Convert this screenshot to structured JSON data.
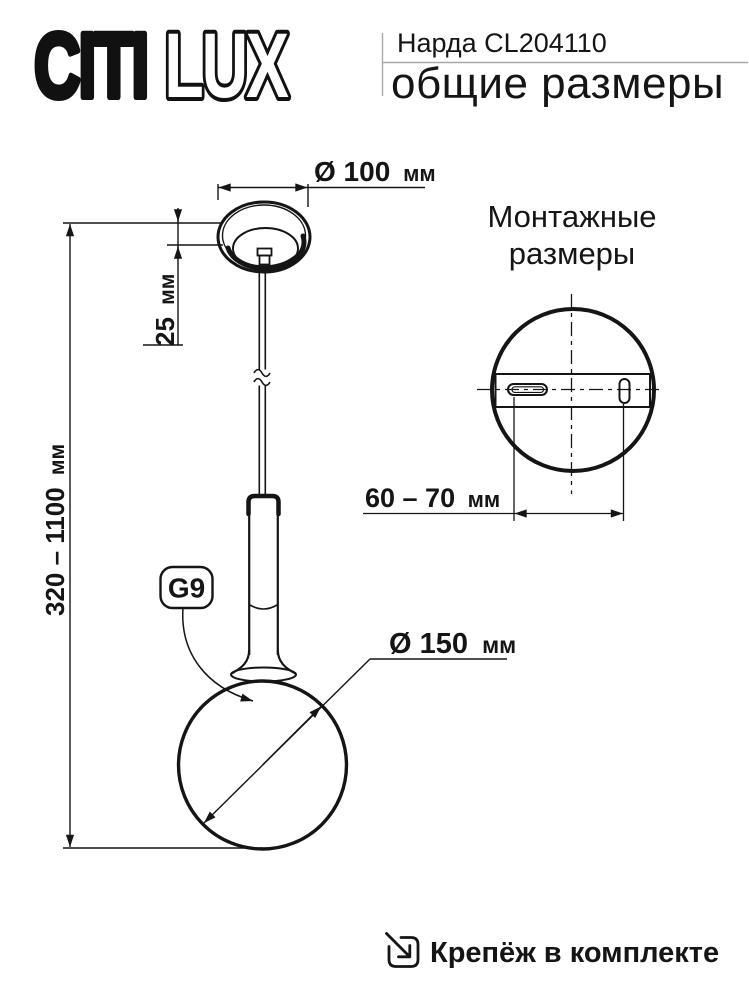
{
  "header": {
    "logo": {
      "part_solid": "CITI",
      "part_outline": "LUX"
    },
    "product_name": "Нарда CL204110",
    "page_subtitle": "общие размеры"
  },
  "dimensions": {
    "canopy_diameter": {
      "value": "Ø 100",
      "unit": "мм"
    },
    "canopy_height": {
      "value": "25",
      "unit": "мм"
    },
    "suspension_height": {
      "value": "320 – 1100",
      "unit": "мм"
    },
    "shade_diameter": {
      "value": "Ø 150",
      "unit": "мм"
    },
    "mounting_holes": {
      "value": "60 – 70",
      "unit": "мм"
    }
  },
  "labels": {
    "socket": "G9",
    "mounting_title_line1": "Монтажные",
    "mounting_title_line2": "размеры",
    "footer_note": "Крепёж в комплекте"
  },
  "icons": {
    "footer": "arrow-into-box-icon",
    "diameter_symbol": "Ø"
  },
  "colors": {
    "line": "#151515",
    "text": "#1a1a1a",
    "divider": "#a8a8a8",
    "background": "#ffffff"
  }
}
